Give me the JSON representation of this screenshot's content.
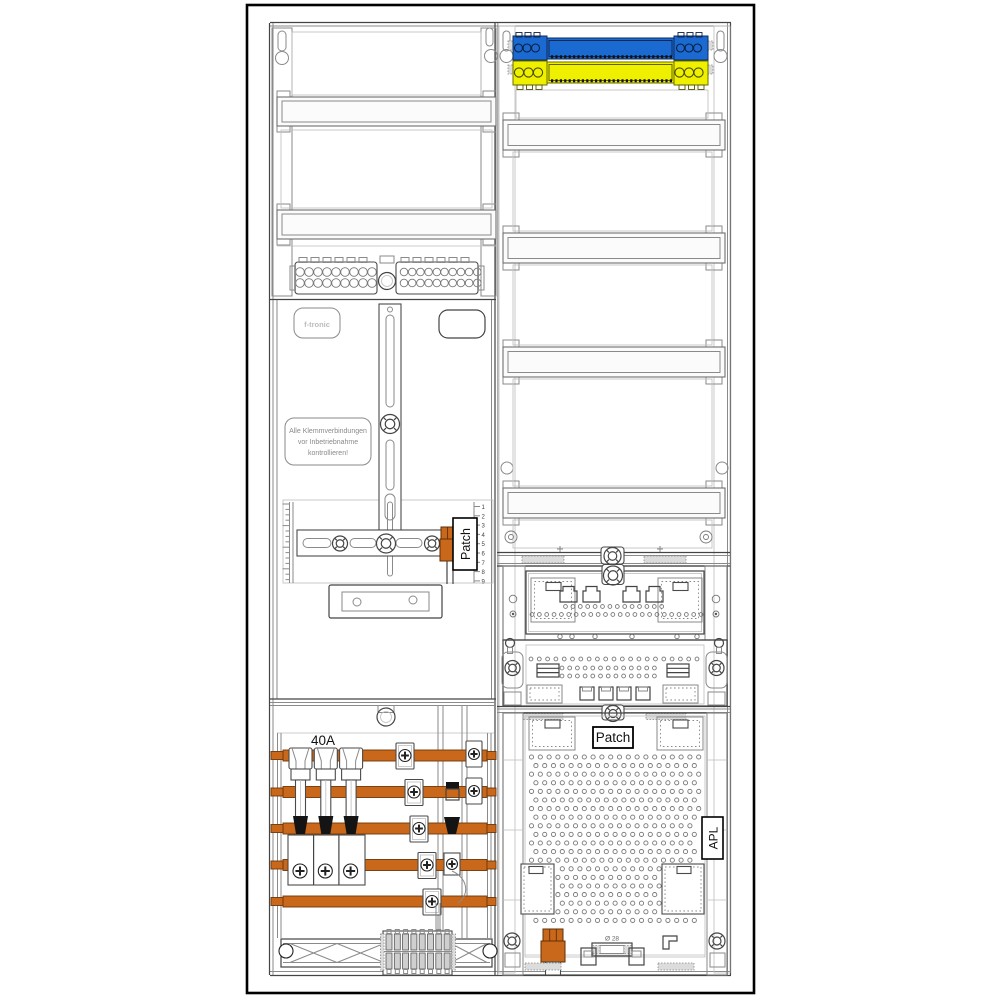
{
  "labels": {
    "brand": "f-tronic",
    "warning_lines": [
      "Alle Klemmverbindungen",
      "vor Inbetriebnahme",
      "kontrollieren!"
    ],
    "breaker_rating": "40A",
    "patch_meter": "Patch",
    "patch_apl": "Patch",
    "apl": "APL",
    "diameter_note": "Ø 28",
    "ruler_numbers": [
      "1",
      "2",
      "3",
      "4",
      "5",
      "6",
      "7",
      "8",
      "9"
    ]
  },
  "colors": {
    "busbar_orange": "#c9681a",
    "neutral_blue": "#1a6ad2",
    "pe_yellow": "#eef000",
    "label_border": "#000000",
    "line_dark": "#444444"
  }
}
